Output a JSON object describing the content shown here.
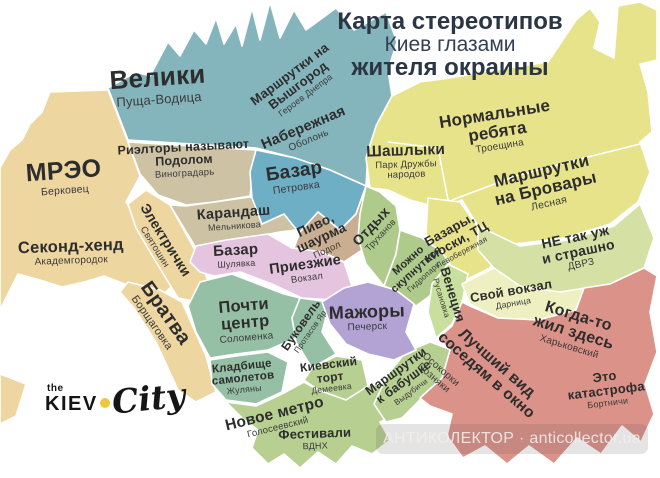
{
  "title": {
    "line1": "Карта стереотипов",
    "line2": "Киев глазами",
    "line3": "жителя окраины"
  },
  "logo": {
    "the": "the",
    "kiev": "KIEV",
    "city": "City"
  },
  "watermark": "АНТИКОЛЕКТОР · anticollector.ua",
  "palette": {
    "teal": "#85b5bc",
    "sand": "#eed6a1",
    "gray_tan": "#cdc3a4",
    "blue": "#6fafc6",
    "brown": "#c9ae91",
    "pink": "#e4c4df",
    "sage": "#96c0a5",
    "yellow": "#e7e38b",
    "green": "#aecb8c",
    "light_green": "#c9df9e",
    "pale_yellow": "#eef0c2",
    "pale_green": "#d5e0a4",
    "purple": "#b3a3d5",
    "green_south": "#b7cf91",
    "salmon": "#db9288",
    "title_color": "#2b3644",
    "label_color": "#2d2d2d",
    "logo_dot": "#f0c63c"
  },
  "regions": {
    "velyky": {
      "label": "Велики",
      "sub": "Пуща-Водица"
    },
    "vyshhorod": {
      "label": "Маршрутки на\nВышгород",
      "sub": "Героев Днепра"
    },
    "naberezhna": {
      "label": "Набережная",
      "sub": "Оболонь"
    },
    "mreo": {
      "label": "МРЭО",
      "sub": "Берковец"
    },
    "secondhand": {
      "label": "Секонд-хенд",
      "sub": "Академгородок"
    },
    "elektrychky": {
      "label": "Электрички",
      "sub": "Святошин"
    },
    "bratva": {
      "label": "Братва",
      "sub": "Борщаговка"
    },
    "rieltory": {
      "label": "Риэлторы называют\nПодолом",
      "sub": "Виноградарь"
    },
    "karandash": {
      "label": "Карандаш",
      "sub": "Мельникова"
    },
    "petrovka": {
      "label": "Базар",
      "sub": "Петровка"
    },
    "pyvo": {
      "label": "Пиво,\nшаурма",
      "sub": "Подол"
    },
    "shulyavka": {
      "label": "Базар",
      "sub": "Шулявка"
    },
    "pryizhi": {
      "label": "Приезжие",
      "sub": "Вокзал"
    },
    "pochti_centr": {
      "label": "Почти\nцентр",
      "sub": "Соломенка"
    },
    "bukovel": {
      "label": "Буковель",
      "sub": "Протасов Яр"
    },
    "kladovyshche": {
      "label": "Кладбище\nсамолетов",
      "sub": "Жуляны"
    },
    "tort": {
      "label": "Киевский\nторт",
      "sub": "Демеевка"
    },
    "nove_metro": {
      "label": "Новое метро",
      "sub": "Голосеевский"
    },
    "festyvali": {
      "label": "Фестивали",
      "sub": "ВДНХ"
    },
    "mazhory": {
      "label": "Мажоры",
      "sub": "Печерск"
    },
    "babushka": {
      "label": "Маршрутки\nк бабушке",
      "sub": "Выдубичи"
    },
    "otdykh": {
      "label": "Отдых",
      "sub": "Труханов"
    },
    "hidropark": {
      "label": "Можно\nскупнуться",
      "sub": "Гидропарк"
    },
    "shashlyky": {
      "label": "Шашлыки",
      "sub": "Парк Дружбы\nнародов"
    },
    "normalni": {
      "label": "Нормальные\nребята",
      "sub": "Троещина"
    },
    "brovary": {
      "label": "Маршрутки\nна Бровары",
      "sub": "Лесная"
    },
    "bazary": {
      "label": "Базары,\nкиоски, ТЦ",
      "sub": "Левобережная"
    },
    "venetsia": {
      "label": "Венеция",
      "sub": "Русановка"
    },
    "vokzal_svoy": {
      "label": "Свой вокзал",
      "sub": "Дарница"
    },
    "dvrz": {
      "label": "НЕ так уж\nи страшно",
      "sub": "ДВРЗ"
    },
    "luchshyi_vid": {
      "label": "Лучший вид\nсоседям в окно",
      "sub": "Осокорки\nПозняки"
    },
    "kogda_to": {
      "label": "Когда-то\nжил здесь",
      "sub": "Харьковский"
    },
    "katastrofa": {
      "label": "Это катастрофа",
      "sub": "Бортничи"
    }
  }
}
